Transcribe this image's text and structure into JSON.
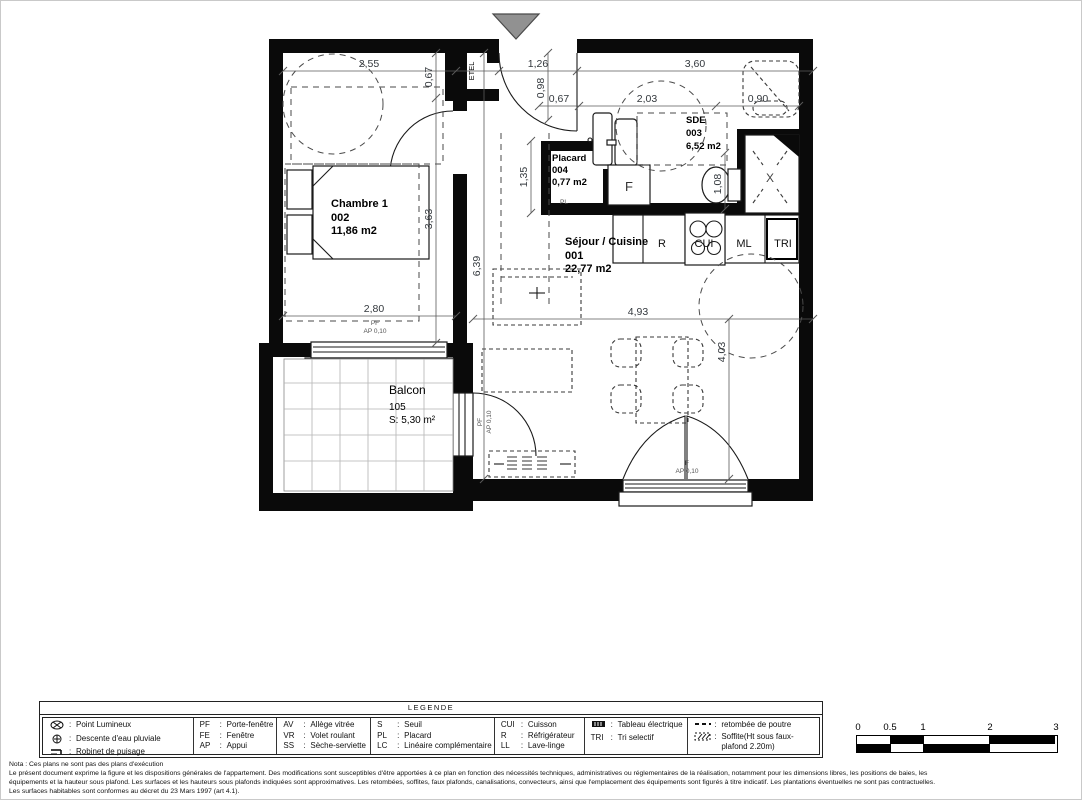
{
  "plan": {
    "rooms": {
      "chambre": {
        "name": "Chambre 1",
        "num": "002",
        "area": "11,86 m2"
      },
      "sejour": {
        "name": "Séjour / Cuisine",
        "num": "001",
        "area": "22,77 m2"
      },
      "sde": {
        "name": "SDE",
        "num": "003",
        "area": "6,52 m2"
      },
      "placard": {
        "name": "Placard",
        "num": "004",
        "area": "0,77 m2"
      },
      "balcon": {
        "name": "Balcon",
        "num": "105",
        "area": "S: 5,30 m²"
      }
    },
    "fixtures": {
      "etel": "ETEL",
      "pl": "PL",
      "f": "F",
      "r": "R",
      "cui": "CUI",
      "ml": "ML",
      "tri": "TRI",
      "shower": "X"
    },
    "dims": {
      "w_chambre_top": "2,55",
      "w_entry": "1,26",
      "w_right_top": "3,60",
      "v_etel": "0,67",
      "v_entry": "0,98",
      "w_placard": "0,67",
      "w_sde": "2,03",
      "w_vanity": "0,90",
      "v_placard": "1,35",
      "v_chambre": "3,63",
      "v_sejour": "6,39",
      "w_chambre_bottom": "2,80",
      "w_sejour": "4,93",
      "v_sejour_right": "4,03",
      "v_wc": "1,08"
    },
    "annos": {
      "pf": "PF",
      "ap": "AP 0,10",
      "f": "F"
    }
  },
  "legend": {
    "title": "LEGENDE",
    "colon": ":",
    "col1": {
      "r1": {
        "l": "Point Lumineux"
      },
      "r2": {
        "l": "Descente d'eau pluviale"
      },
      "r3": {
        "l": "Robinet de puisage"
      }
    },
    "col2": {
      "r1": {
        "a": "PF",
        "l": "Porte-fenêtre"
      },
      "r2": {
        "a": "FE",
        "l": "Fenêtre"
      },
      "r3": {
        "a": "AP",
        "l": "Appui"
      }
    },
    "col3": {
      "r1": {
        "a": "AV",
        "l": "Allège vitrée"
      },
      "r2": {
        "a": "VR",
        "l": "Volet roulant"
      },
      "r3": {
        "a": "SS",
        "l": "Sèche-serviette"
      }
    },
    "col4": {
      "r1": {
        "a": "S",
        "l": "Seuil"
      },
      "r2": {
        "a": "PL",
        "l": "Placard"
      },
      "r3": {
        "a": "LC",
        "l": "Linéaire complémentaire"
      }
    },
    "col5": {
      "r1": {
        "a": "CUI",
        "l": "Cuisson"
      },
      "r2": {
        "a": "R",
        "l": "Réfrigérateur"
      },
      "r3": {
        "a": "LL",
        "l": "Lave-linge"
      }
    },
    "col6": {
      "r1": {
        "l": "Tableau électrique"
      },
      "r2": {
        "a": "TRI",
        "l": "Tri selectif"
      }
    },
    "col7": {
      "r1": {
        "l": "retombée de poutre"
      },
      "r2": {
        "l": "Soffite(Ht sous faux-plafond 2.20m)"
      }
    }
  },
  "notes": {
    "l1": "Nota : Ces plans ne sont pas des plans d'exécution",
    "l2": "Le présent document exprime la figure et les dispositions générales de l'appartement. Des modifications sont susceptibles d'être apportées à ce plan en fonction des nécessités techniques, administratives ou réglementaires de la réalisation, notamment pour les dimensions libres, les positions de baies, les",
    "l3": "équipements et la hauteur sous plafond. Les surfaces et les hauteurs sous plafonds indiquées sont approximatives. Les retombées, soffites, faux plafonds, canalisations, convecteurs, ainsi que l'emplacement des équipements sont figurés à titre indicatif. Les plantations éventuelles ne sont pas contractuelles.",
    "l4": "Les surfaces habitables sont conformes au décret du 23 Mars 1997 (art 4.1)."
  },
  "scale": {
    "t0": "0",
    "t1": "0.5",
    "t2": "1",
    "t3": "2",
    "t4": "3"
  }
}
